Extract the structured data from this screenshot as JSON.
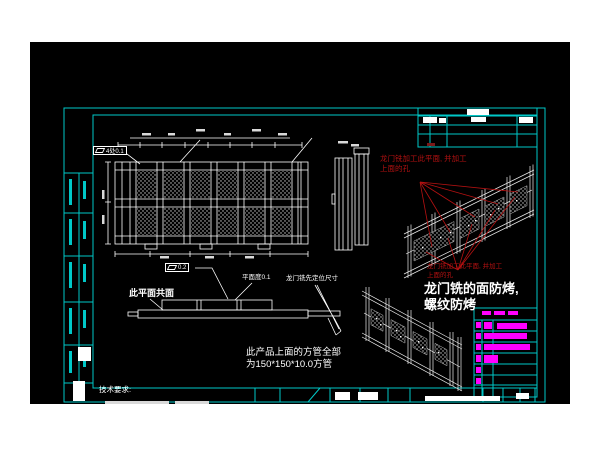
{
  "drawing": {
    "background": "#000000",
    "page_background": "#ffffff",
    "frame_color": "#00c8c8",
    "line_color": "#ffffff",
    "annotation_red": "#b31111",
    "highlight_magenta": "#ff00ff"
  },
  "labels": {
    "fcf_flatness_4x": "4处0.1",
    "fcf_flatness_02": "0.2",
    "coplanar": "此平面共面",
    "flatness_note": "平面度0.1",
    "gantry_first_dim": "龙门铣先定位尺寸",
    "red_note_1_line1": "龙门铣加工此平面, 并加工",
    "red_note_1_line2": "上面的孔",
    "red_note_2_line1": "龙门铣加工此平面, 并加工",
    "red_note_2_line2": "上面的孔",
    "milling_note_line1": "龙门铣的面防烤,",
    "milling_note_line2": "螺纹防烤",
    "tube_note_line1": "此产品上面的方管全部",
    "tube_note_line2": "为150*150*10.0方管",
    "tech_req": "技术要求:"
  }
}
